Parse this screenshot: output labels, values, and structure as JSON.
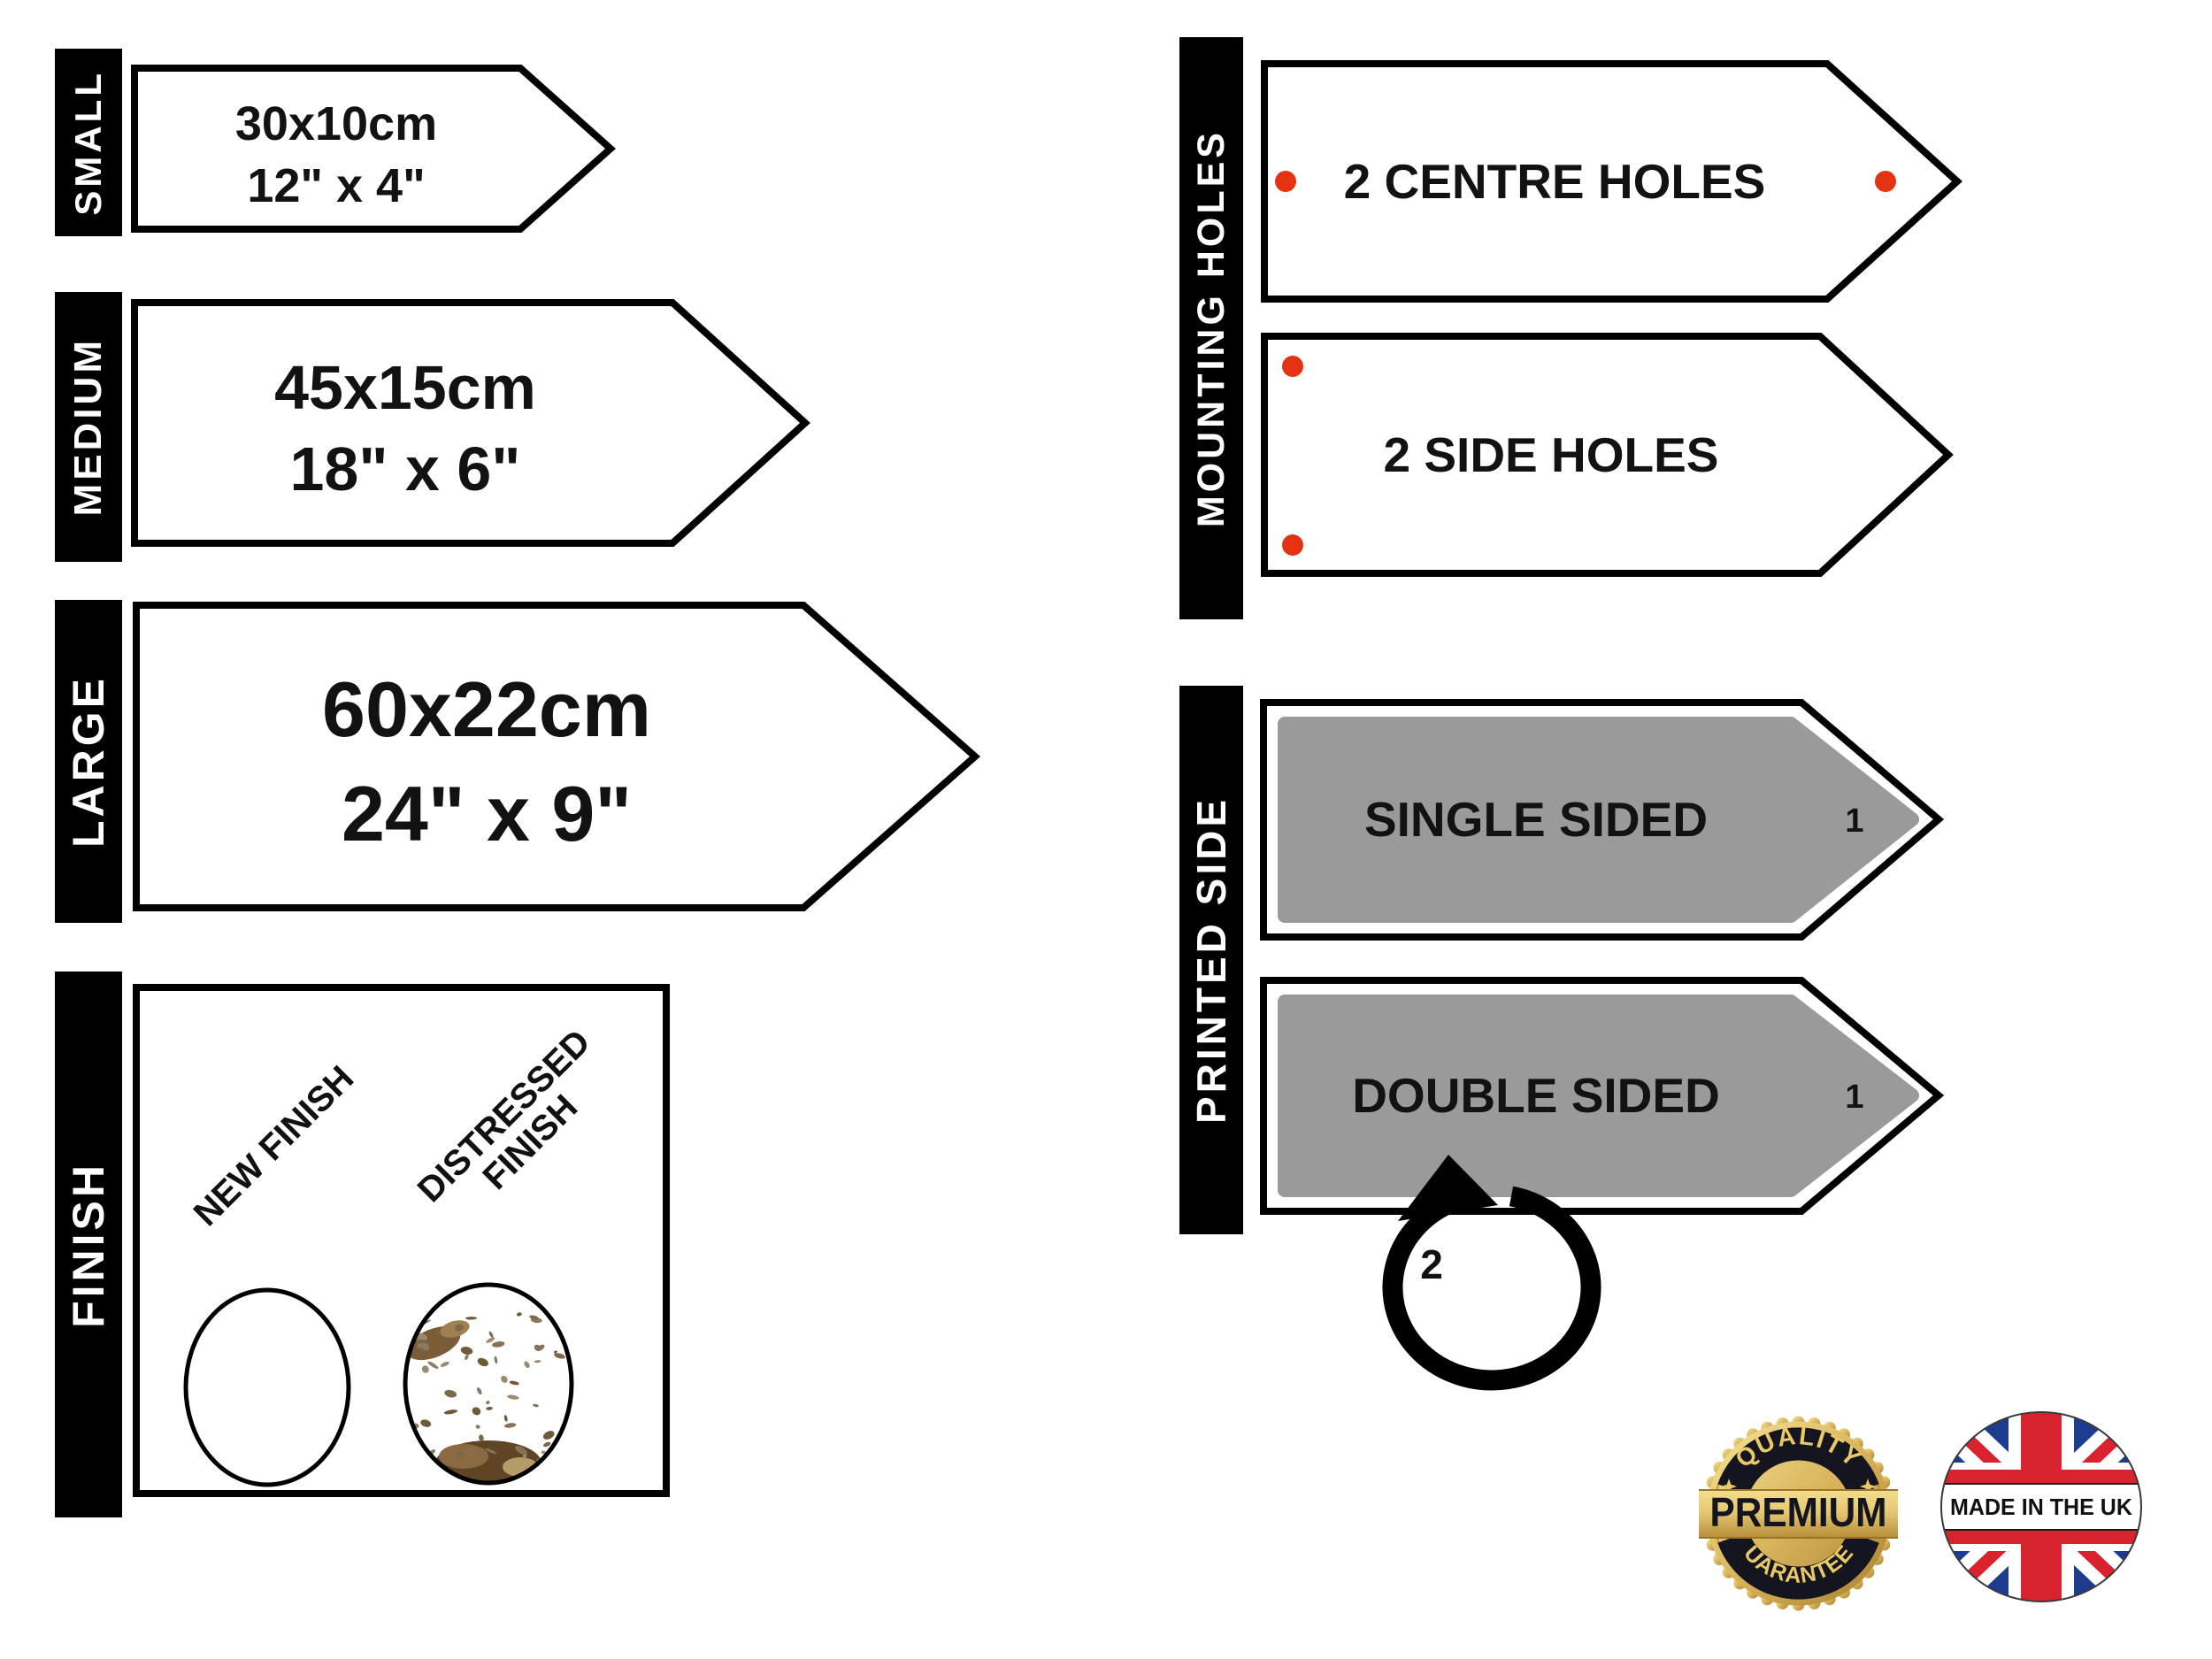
{
  "sizes": {
    "small": {
      "label": "SMALL",
      "cm": "30x10cm",
      "inches": "12\" x 4\""
    },
    "medium": {
      "label": "MEDIUM",
      "cm": "45x15cm",
      "inches": "18\" x 6\""
    },
    "large": {
      "label": "LARGE",
      "cm": "60x22cm",
      "inches": "24\" x 9\""
    }
  },
  "finish": {
    "label": "FINISH",
    "new_finish": "NEW FINISH",
    "distressed_line1": "DISTRESSED",
    "distressed_line2": "FINISH"
  },
  "mounting": {
    "label": "MOUNTING HOLES",
    "centre_sign": "2 CENTRE HOLES",
    "side_sign": "2 SIDE HOLES"
  },
  "printed": {
    "label": "PRINTED SIDE",
    "single_sign": "SINGLE SIDED",
    "double_sign": "DOUBLE SIDED",
    "face_one": "1",
    "face_two": "2"
  },
  "badges": {
    "premium": {
      "arc_top": "QUALITY",
      "center": "PREMIUM",
      "arc_bottom": "GUARANTEED"
    },
    "uk": {
      "text": "MADE IN THE UK"
    }
  },
  "colors": {
    "hole_dot": "#e53212",
    "printed_fill": "#9a9a9a",
    "label_bg": "#000000",
    "sign_outline": "#000000",
    "uk_blue": "#1d3c8f",
    "uk_red": "#d8232f",
    "gold_text": "#e8c96a",
    "band_dark": "#15151f"
  }
}
